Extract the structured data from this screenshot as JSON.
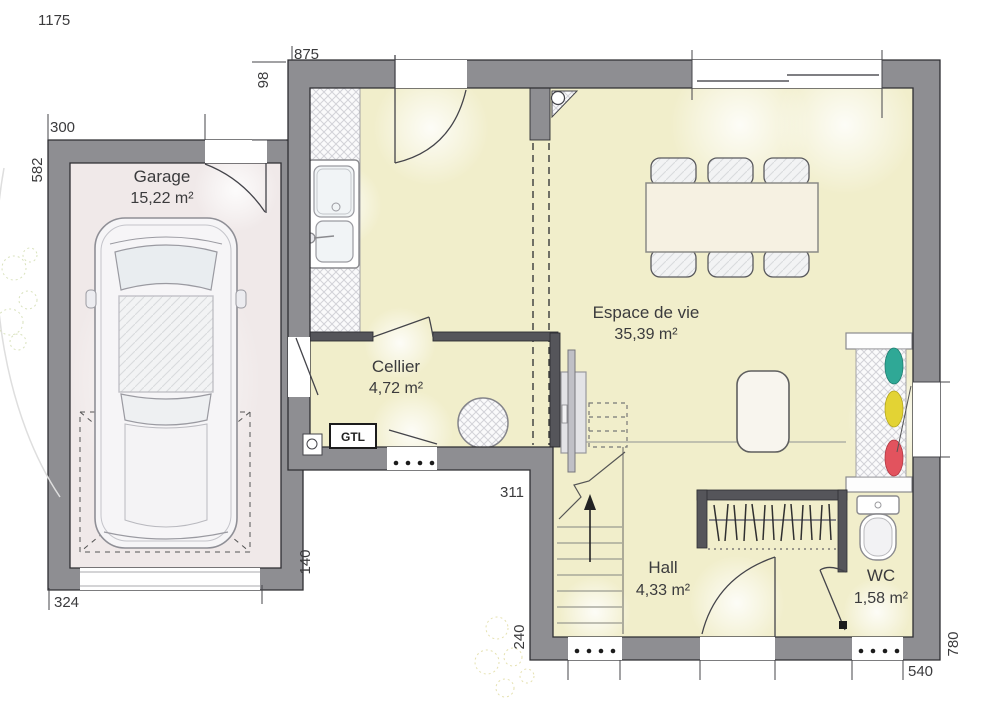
{
  "plan": {
    "title": "Floor plan - ground floor",
    "rooms": {
      "garage": {
        "name": "Garage",
        "area": "15,22 m²"
      },
      "cellier": {
        "name": "Cellier",
        "area": "4,72 m²"
      },
      "espace": {
        "name": "Espace de vie",
        "area": "35,39 m²"
      },
      "hall": {
        "name": "Hall",
        "area": "4,33 m²"
      },
      "wc": {
        "name": "WC",
        "area": "1,58 m²"
      }
    },
    "labels": {
      "gtl": "GTL"
    },
    "dimensions": {
      "total_width": "1175",
      "house_top": "875",
      "top_offset": "98",
      "garage_top": "300",
      "garage_left": "582",
      "garage_bottom": "324",
      "garage_right": "140",
      "cellier_bottom": "311",
      "hall_left": "240",
      "house_bottom": "540",
      "house_right": "780"
    },
    "colors": {
      "exterior_wall": "#8e8e92",
      "partition_wall": "#55555a",
      "house_floor": "#f1eecb",
      "garage_floor": "#f0e9e9",
      "accent_teal": "#2fa896",
      "accent_yellow": "#e3d334",
      "accent_red": "#e2535e"
    }
  }
}
